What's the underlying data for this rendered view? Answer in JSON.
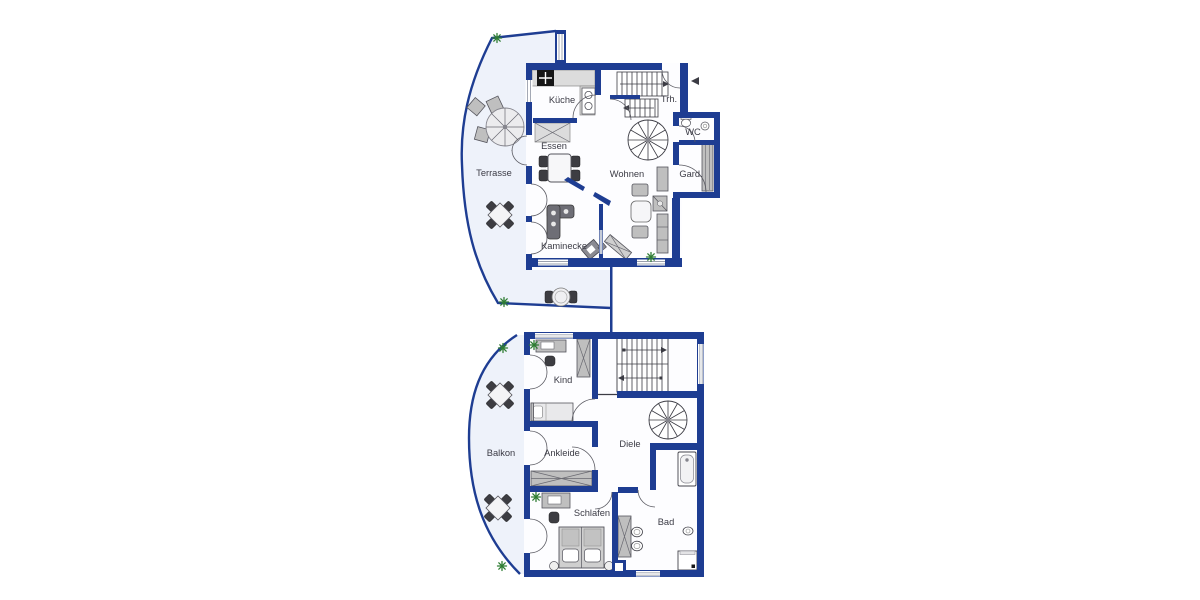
{
  "image_type": "architectural floor plan, two storeys",
  "colors": {
    "wall_blue": "#1e3d92",
    "outdoor_fill": "#eef2fa",
    "room_fill": "#fdfdff",
    "furniture_gray": "#bfbfbf",
    "plant_green": "#2f7d33",
    "label_text": "#3b3b45"
  },
  "plans": {
    "upper": {
      "name": "upper floor plan",
      "rooms": [
        {
          "id": "kueche",
          "label": "Küche"
        },
        {
          "id": "trh",
          "label": "Trh."
        },
        {
          "id": "essen",
          "label": "Essen"
        },
        {
          "id": "terrasse",
          "label": "Terrasse"
        },
        {
          "id": "wohnen",
          "label": "Wohnen"
        },
        {
          "id": "wc",
          "label": "WC"
        },
        {
          "id": "gard",
          "label": "Gard."
        },
        {
          "id": "kaminecke",
          "label": "Kaminecke"
        }
      ]
    },
    "lower": {
      "name": "lower floor plan",
      "rooms": [
        {
          "id": "kind",
          "label": "Kind"
        },
        {
          "id": "balkon",
          "label": "Balkon"
        },
        {
          "id": "ankleide",
          "label": "Ankleide"
        },
        {
          "id": "diele",
          "label": "Diele"
        },
        {
          "id": "schlafen",
          "label": "Schlafen"
        },
        {
          "id": "bad",
          "label": "Bad"
        }
      ]
    }
  }
}
